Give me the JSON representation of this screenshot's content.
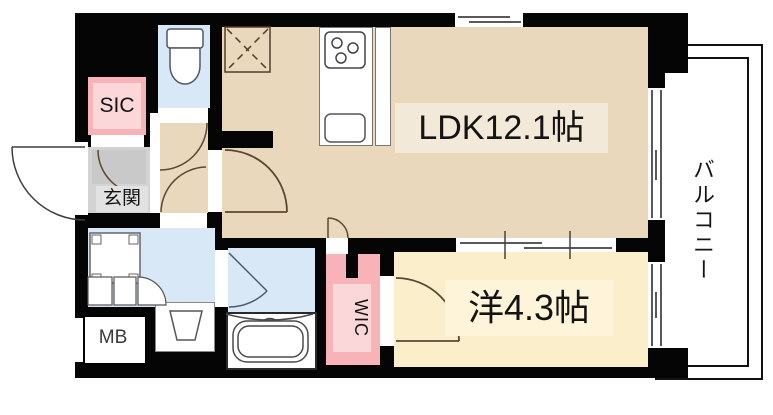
{
  "floorplan": {
    "type": "japanese-apartment-floorplan",
    "labels": {
      "ldk": "LDK12.1帖",
      "western_room": "洋4.3帖",
      "balcony": "バルコニー",
      "entrance": "玄関",
      "shoe_closet": "SIC",
      "walk_in_closet": "WIC",
      "meter_box": "MB"
    },
    "colors": {
      "wall": "#050505",
      "ldk_floor": "#e9d8bc",
      "western_floor": "#fbeeca",
      "wet_area_floor": "#d9e8f7",
      "entrance_floor": "#d3d3d3",
      "closet_pink": "#f7b3b8",
      "closet_pink_light": "#fbd7d9",
      "label_bg_ldk": "#f2e9d8",
      "label_bg_western": "#fdf4da",
      "door_arc": "#5c4733",
      "wet_arc": "#4e5a66"
    }
  }
}
